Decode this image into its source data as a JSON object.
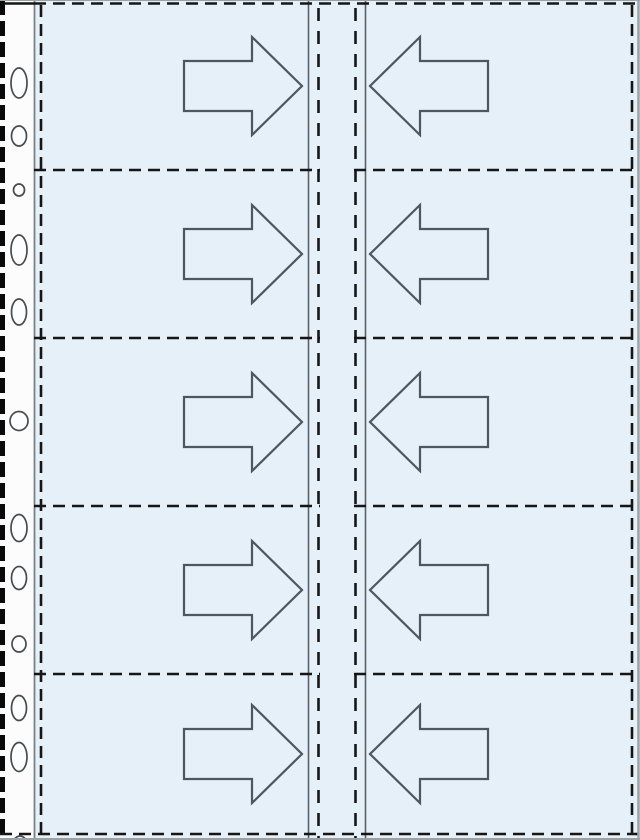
{
  "diagram": {
    "name": "binder-pocket-sheet-illustration",
    "description": "Punched binder pocket page, 2 columns x 5 rows of pockets, arrows show card insertion direction toward center spine",
    "canvas": {
      "width": 640,
      "height": 840
    },
    "colors": {
      "page_bg": "#ffffff",
      "sheet_fill": "#e6f0f8",
      "strip_fill": "#fcfcfc",
      "dash_line": "#161616",
      "left_edge_black": "#0a0a0a",
      "solid_gray_line": "#7b8187",
      "center_solid_line": "#5a6167",
      "outer_edge_gray": "#9aa1a7",
      "arrow_outline": "#4e575e",
      "hole_stroke": "#454c52",
      "hole_fill": "#fdfdfd"
    },
    "layout": {
      "strip": {
        "x": 0,
        "width": 34
      },
      "sheet": {
        "x": 34,
        "y": 1,
        "width": 604,
        "height": 838
      },
      "left_edge_dash": {
        "x": 2.5,
        "stroke_width": 5,
        "dash": [
          15,
          6
        ]
      },
      "strip_border_x": 34.5,
      "pocket_left_dash_x": 41,
      "center_strip": {
        "solid_x": [
          308.5,
          365.5
        ],
        "inner_dash_x": [
          318.5,
          355.5
        ]
      },
      "right_dash_x": 632,
      "right_edge_x": 638.5,
      "top_hairline_y": 0.5,
      "top_dash_y": 3.5,
      "top_strip_cap": [
        4,
        35
      ],
      "bottom_dash_y": 834,
      "bottom_edge_y": 839,
      "divider_y": [
        170,
        338,
        506,
        674
      ],
      "divider_left_span": [
        34,
        320
      ],
      "divider_right_span": [
        354,
        637
      ],
      "pocket_dash": {
        "stroke_width": 2.6,
        "dash": [
          12,
          7
        ]
      },
      "center_dash": {
        "stroke_width": 2.6,
        "dash": [
          13,
          10
        ]
      }
    },
    "arrow_geometry": {
      "total_width": 118,
      "total_height": 98,
      "tail_length": 68,
      "head_length": 50,
      "shaft_height": 50,
      "stroke_width": 2.2,
      "right_arrow_x": 184,
      "left_arrow_x": 370
    },
    "rows": [
      {
        "index": 1,
        "center_y": 86,
        "left_pocket_arrow": "right",
        "right_pocket_arrow": "left"
      },
      {
        "index": 2,
        "center_y": 254,
        "left_pocket_arrow": "right",
        "right_pocket_arrow": "left"
      },
      {
        "index": 3,
        "center_y": 422,
        "left_pocket_arrow": "right",
        "right_pocket_arrow": "left"
      },
      {
        "index": 4,
        "center_y": 590,
        "left_pocket_arrow": "right",
        "right_pocket_arrow": "left"
      },
      {
        "index": 5,
        "center_y": 754,
        "left_pocket_arrow": "right",
        "right_pocket_arrow": "left"
      }
    ],
    "punch_holes": [
      {
        "cx": 19,
        "cy": 83,
        "rx": 8,
        "ry": 15
      },
      {
        "cx": 19,
        "cy": 136,
        "rx": 7.5,
        "ry": 10
      },
      {
        "cx": 19,
        "cy": 190,
        "rx": 5.5,
        "ry": 6
      },
      {
        "cx": 19,
        "cy": 250,
        "rx": 8,
        "ry": 15
      },
      {
        "cx": 19,
        "cy": 312,
        "rx": 7.5,
        "ry": 13
      },
      {
        "cx": 19,
        "cy": 421,
        "rx": 9,
        "ry": 9.5
      },
      {
        "cx": 19,
        "cy": 528,
        "rx": 8,
        "ry": 13.5
      },
      {
        "cx": 19,
        "cy": 578,
        "rx": 7.5,
        "ry": 11.5
      },
      {
        "cx": 19,
        "cy": 644,
        "rx": 7,
        "ry": 8
      },
      {
        "cx": 19,
        "cy": 708,
        "rx": 7.5,
        "ry": 12.5
      },
      {
        "cx": 19,
        "cy": 757,
        "rx": 8,
        "ry": 14.5
      },
      {
        "cx": 20,
        "cy": 848,
        "rx": 8,
        "ry": 12
      }
    ]
  }
}
